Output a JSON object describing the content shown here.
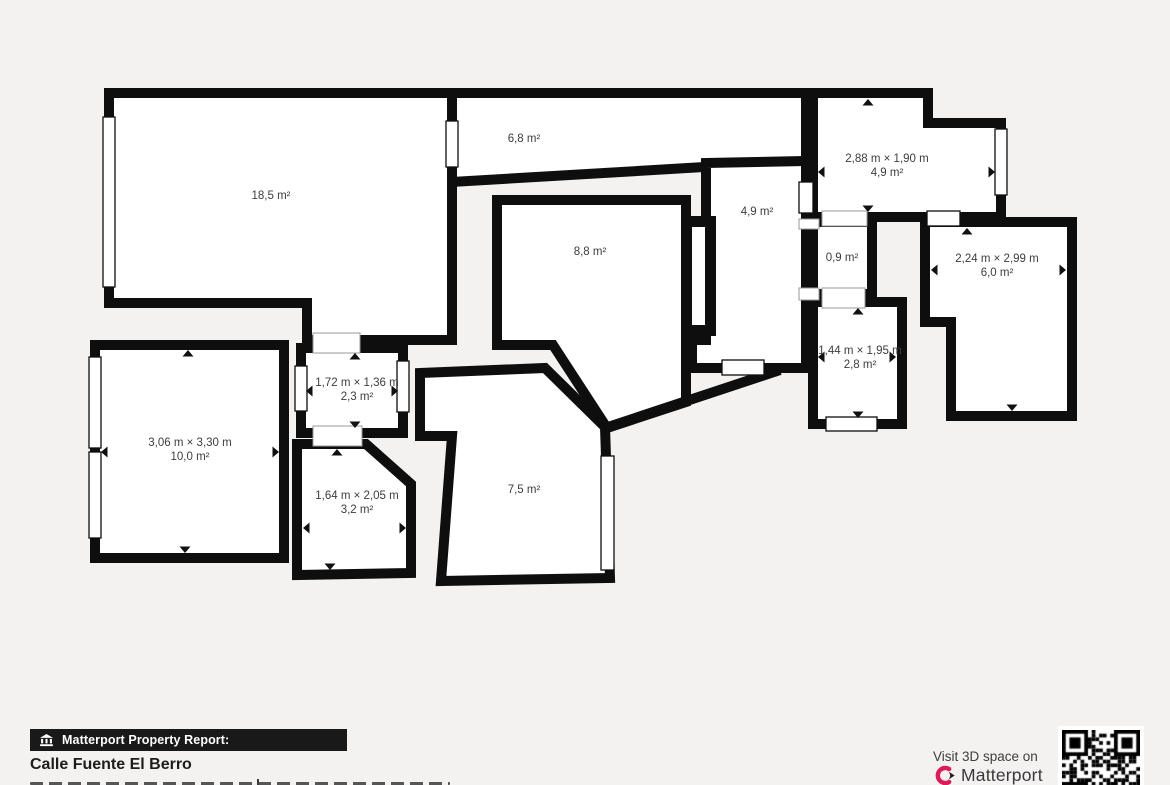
{
  "floorplan": {
    "rooms": [
      {
        "id": "room-18-5",
        "dims": "",
        "area": "18,5 m²"
      },
      {
        "id": "room-6-8",
        "dims": "",
        "area": "6,8 m²"
      },
      {
        "id": "room-4-9-top-right",
        "dims": "2,88 m × 1,90 m",
        "area": "4,9 m²"
      },
      {
        "id": "room-4-9-hall",
        "dims": "",
        "area": "4,9 m²"
      },
      {
        "id": "room-8-8",
        "dims": "",
        "area": "8,8 m²"
      },
      {
        "id": "room-0-9",
        "dims": "",
        "area": "0,9 m²"
      },
      {
        "id": "room-6-0",
        "dims": "2,24 m × 2,99 m",
        "area": "6,0 m²"
      },
      {
        "id": "room-2-8",
        "dims": "1,44 m × 1,95 m",
        "area": "2,8 m²"
      },
      {
        "id": "room-2-3",
        "dims": "1,72 m × 1,36 m",
        "area": "2,3 m²"
      },
      {
        "id": "room-10-0",
        "dims": "3,06 m × 3,30 m",
        "area": "10,0 m²"
      },
      {
        "id": "room-3-2",
        "dims": "1,64 m × 2,05 m",
        "area": "3,2 m²"
      },
      {
        "id": "room-7-5",
        "dims": "",
        "area": "7,5 m²"
      }
    ]
  },
  "footer": {
    "badge_label": "Matterport Property Report:",
    "property_name": "Calle Fuente El Berro",
    "visit_text": "Visit 3D space on",
    "brand_name": "Matterport"
  },
  "colors": {
    "wall": "#0e0e0e",
    "background": "#f3f2f0",
    "room_fill": "#ffffff",
    "label_text": "#3d3d3d",
    "brand_pink": "#df1a5a"
  }
}
